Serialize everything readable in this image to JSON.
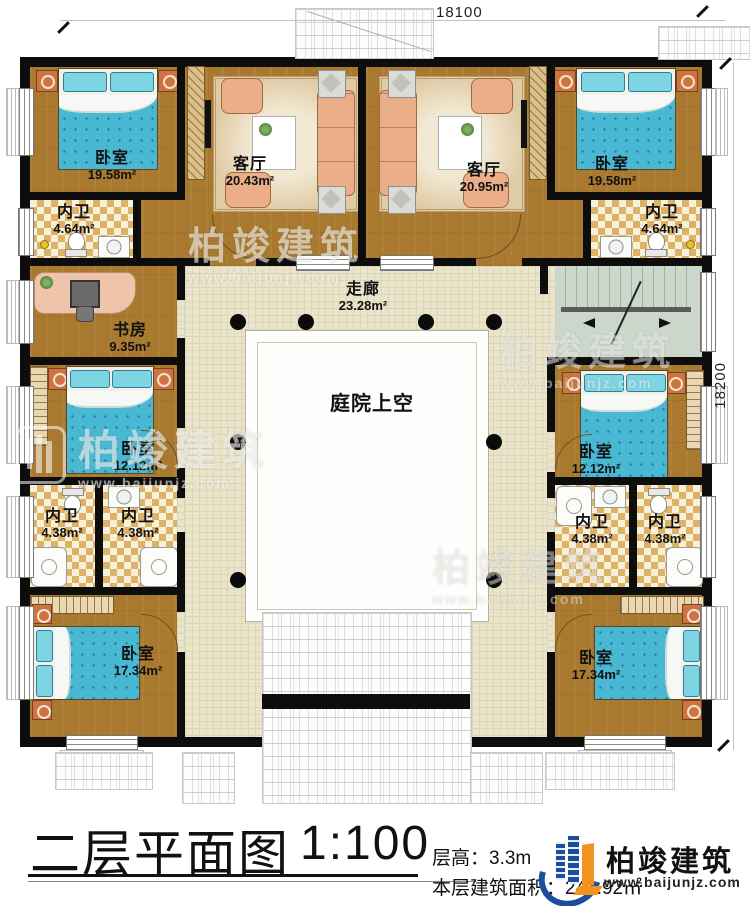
{
  "dimensions": {
    "top": "18100",
    "right": "18200"
  },
  "rooms": [
    {
      "id": "bedroom-top-left",
      "name": "卧室",
      "area": "19.58m²"
    },
    {
      "id": "living-left",
      "name": "客厅",
      "area": "20.43m²"
    },
    {
      "id": "living-right",
      "name": "客厅",
      "area": "20.95m²"
    },
    {
      "id": "bedroom-top-right",
      "name": "卧室",
      "area": "19.58m²"
    },
    {
      "id": "bath-top-left",
      "name": "内卫",
      "area": "4.64m²"
    },
    {
      "id": "bath-top-right",
      "name": "内卫",
      "area": "4.64m²"
    },
    {
      "id": "study",
      "name": "书房",
      "area": "9.35m²"
    },
    {
      "id": "corridor",
      "name": "走廊",
      "area": "23.28m²"
    },
    {
      "id": "bedroom-mid-left",
      "name": "卧室",
      "area": "12.12m²"
    },
    {
      "id": "bedroom-mid-right",
      "name": "卧室",
      "area": "12.12m²"
    },
    {
      "id": "courtyard",
      "name": "庭院上空",
      "area": ""
    },
    {
      "id": "bath-left-1",
      "name": "内卫",
      "area": "4.38m²"
    },
    {
      "id": "bath-left-2",
      "name": "内卫",
      "area": "4.38m²"
    },
    {
      "id": "bath-right-1",
      "name": "内卫",
      "area": "4.38m²"
    },
    {
      "id": "bath-right-2",
      "name": "内卫",
      "area": "4.38m²"
    },
    {
      "id": "bedroom-bottom-left",
      "name": "卧室",
      "area": "17.34m²"
    },
    {
      "id": "bedroom-bottom-right",
      "name": "卧室",
      "area": "17.34m²"
    }
  ],
  "watermark": {
    "brand": "柏竣建筑",
    "url": "www.baijunjz.com"
  },
  "title_block": {
    "title": "二层平面图",
    "scale": "1:100",
    "floor_height": "层高：3.3m",
    "floor_area": "本层建筑面积：241.92㎡",
    "brand": "柏竣建筑",
    "brand_url": "www.baijunjz.com"
  }
}
